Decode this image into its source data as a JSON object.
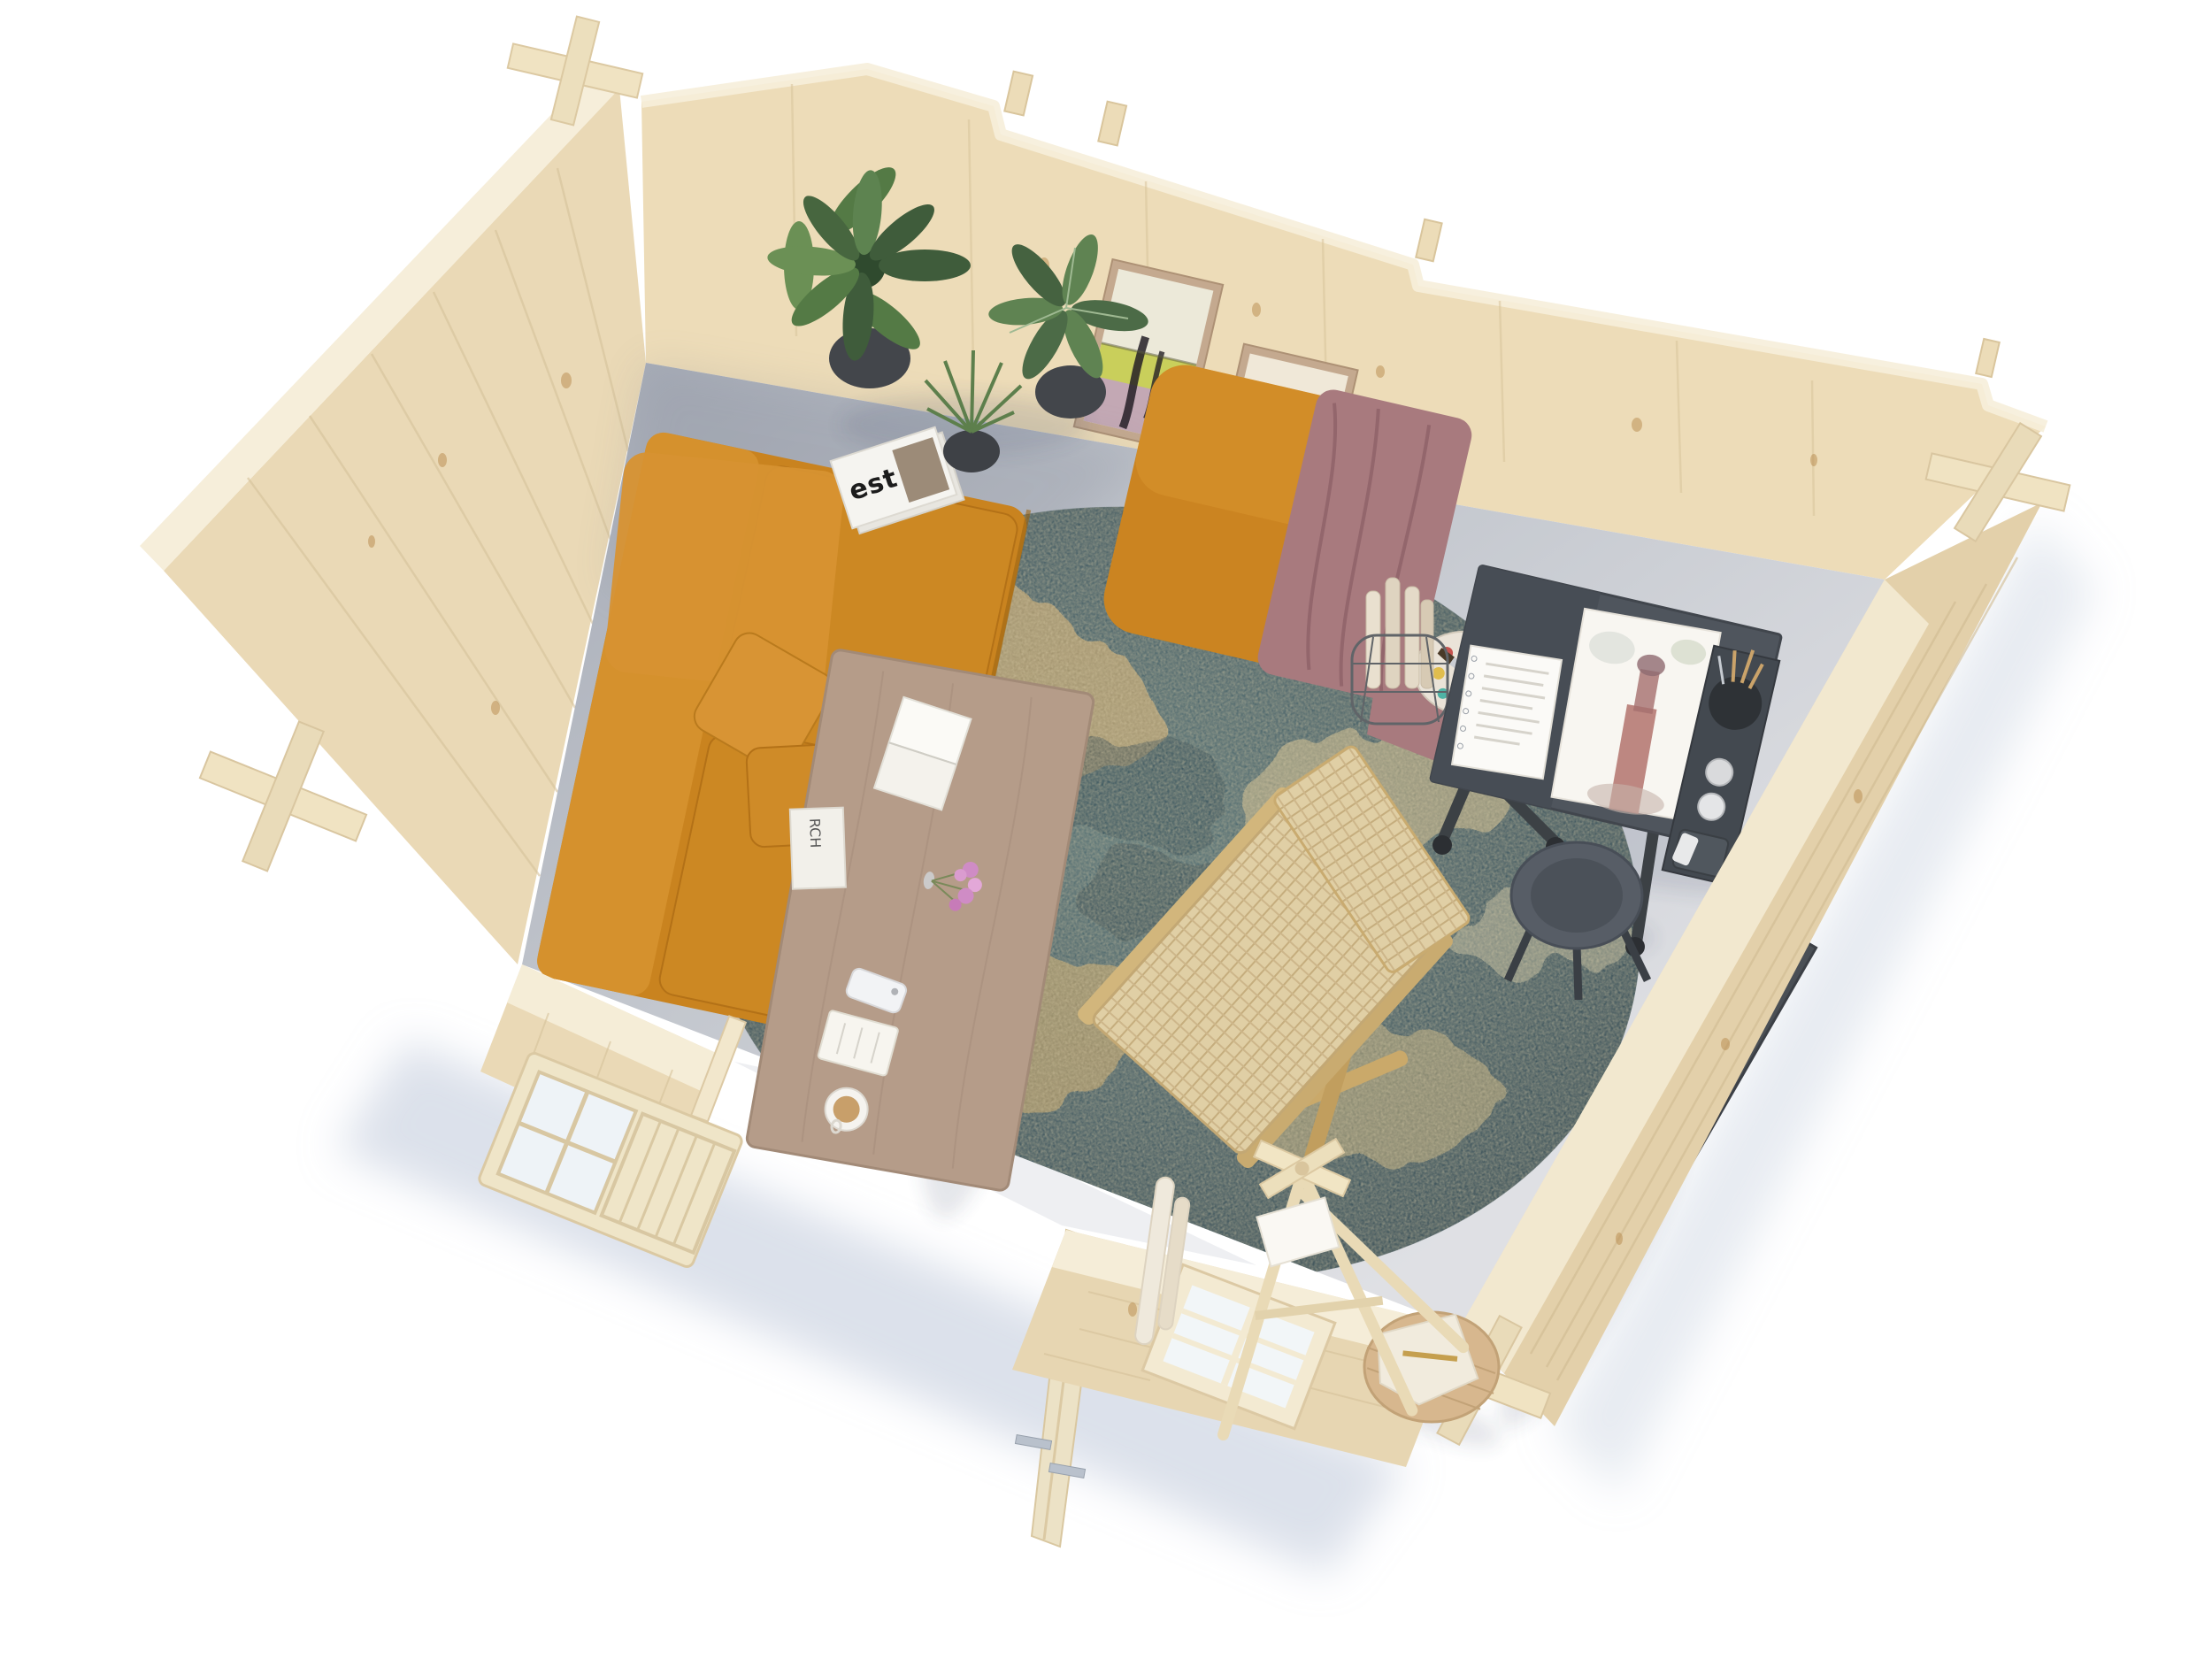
{
  "meta": {
    "subject": "Aerial cutaway 3D render of a log cabin art-studio interior",
    "view": "top-down isometric product render",
    "background": "#ffffff"
  },
  "objects": {
    "magazine": {
      "title": "est"
    },
    "table_magazine": {
      "title": "RCH"
    },
    "labels": [
      "log-cabin shell",
      "interior concrete floor",
      "tan leather sofa with pillows",
      "tan leather pouf with draped blanket",
      "round abstract teal and gold rug",
      "wooden coffee table with book, flowers, phone and coffee",
      "cane lounge chair",
      "three potted plants",
      "est magazine on floor",
      "two framed abstract paintings",
      "dark drafting desk with watercolor of a tower",
      "artist side console with brushes and paints",
      "round dark stool",
      "art-supply bench along right wall",
      "leaning canvases and paper rolls",
      "wooden stool with cloth",
      "folding wooden easel",
      "paint palette with brush",
      "wire basket with paper rolls",
      "open double door",
      "glazed single door leaf",
      "six-pane window",
      "four-pane wall window"
    ]
  },
  "colors": {
    "wood_face": "#ead9b6",
    "wood_back": "#eddcb8",
    "wood_outer": "#e3d0aa",
    "wood_cap": "#f6eeda",
    "wood_grain": "#d6c29a",
    "wood_knot": "#b8894c",
    "log_end": "#f0e3c2",
    "floor_far": "#a6abb6",
    "floor_mid": "#c2c6cd",
    "floor_near": "#dfe0e4",
    "ground_shadow": "#b9c4d8",
    "glass": "#eef3f7",
    "sofa": "#c9831f",
    "sofa_light": "#d79232",
    "sofa_dark": "#a96c15",
    "pouf": "#cb8421",
    "blanket": "#a87a7e",
    "rug_teal": "#3a5560",
    "rug_dark": "#263d49",
    "rug_gold": "#c8a76e",
    "rug_cream": "#ded0ab",
    "table": "#b59c89",
    "cane": "#e0cfa5",
    "cane_frame": "#d2b67c",
    "plant": "#547a45",
    "plant_dark": "#3f5c3b",
    "pot": "#43464b",
    "desk": "#4f555d",
    "desk_side": "#434950",
    "stool_dark": "#575d66",
    "bench": "#4a4f55",
    "easel": "#e9dab6",
    "stool_wood": "#d7b78e",
    "cloth": "#f1ebdd",
    "palette": "#eae3d8",
    "paper": "#f8f6f1",
    "frame": "#c4a98f",
    "art1_field": "#c9cf5b",
    "art1_rose": "#c3a8b4",
    "art2_pink": "#e2a9be",
    "art2_mauve": "#98829f",
    "art_stroke": "#241f26",
    "tower_red": "#b3736d",
    "metal": "#b9c1cc",
    "phone": "#f2f3f5",
    "flowers": "#cf8cc5",
    "coffee": "#c89f6a"
  }
}
